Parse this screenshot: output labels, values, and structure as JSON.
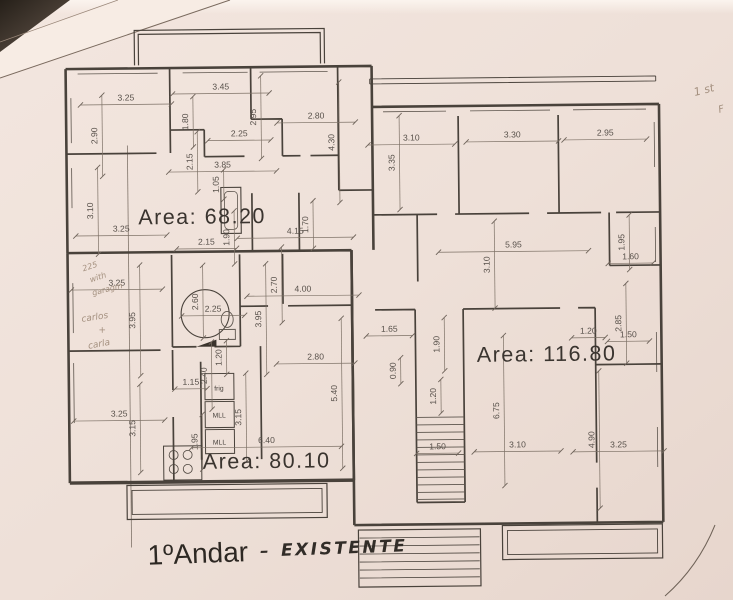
{
  "plan": {
    "caption": {
      "typed": "1ºAndar",
      "dash": "–",
      "handwritten": "EXISTENTE"
    },
    "areas": [
      {
        "text": "Area:  68.20",
        "x": 203,
        "y": 222
      },
      {
        "text": "Area:  116.80",
        "x": 546,
        "y": 363
      },
      {
        "text": "Area:  80.10",
        "x": 265,
        "y": 467
      }
    ],
    "fixtures": [
      {
        "t": "frig",
        "x": 218,
        "y": 389
      },
      {
        "t": "MLL",
        "x": 218,
        "y": 416
      },
      {
        "t": "MLL",
        "x": 218,
        "y": 443
      }
    ],
    "handwritten_notes": [
      {
        "t": "1 st",
        "x": 707,
        "y": 97,
        "s": 11,
        "r": -14
      },
      {
        "t": "F",
        "x": 724,
        "y": 116,
        "s": 10,
        "r": -14
      },
      {
        "t": "225",
        "x": 91,
        "y": 266,
        "s": 8,
        "r": -18
      },
      {
        "t": "with",
        "x": 99,
        "y": 277,
        "s": 8,
        "r": -18
      },
      {
        "t": "garagm",
        "x": 108,
        "y": 289,
        "s": 8,
        "r": -14
      },
      {
        "t": "carlos",
        "x": 95,
        "y": 317,
        "s": 9,
        "r": -8
      },
      {
        "t": "+",
        "x": 102,
        "y": 330,
        "s": 9,
        "r": 0
      },
      {
        "t": "carla",
        "x": 99,
        "y": 344,
        "s": 9,
        "r": -10
      }
    ],
    "dimensions": [
      {
        "t": "3.25",
        "x": 128,
        "y": 98,
        "r": 0
      },
      {
        "t": "2.90",
        "x": 99,
        "y": 133,
        "r": -90
      },
      {
        "t": "3.45",
        "x": 223,
        "y": 88,
        "r": 0
      },
      {
        "t": "1.80",
        "x": 190,
        "y": 120,
        "r": -90
      },
      {
        "t": "2.95",
        "x": 258,
        "y": 116,
        "r": -90
      },
      {
        "t": "2.25",
        "x": 241,
        "y": 135,
        "r": 0
      },
      {
        "t": "2.80",
        "x": 318,
        "y": 118,
        "r": 0
      },
      {
        "t": "4.30",
        "x": 336,
        "y": 142,
        "r": -90
      },
      {
        "t": "2.15",
        "x": 194,
        "y": 160,
        "r": -90
      },
      {
        "t": "3.85",
        "x": 224,
        "y": 166,
        "r": 0
      },
      {
        "t": "1.05",
        "x": 220,
        "y": 183,
        "r": -90
      },
      {
        "t": "3.10",
        "x": 94,
        "y": 208,
        "r": -90
      },
      {
        "t": "3.25",
        "x": 122,
        "y": 229,
        "r": 0
      },
      {
        "t": "2.15",
        "x": 207,
        "y": 243,
        "r": 0
      },
      {
        "t": "1.90",
        "x": 230,
        "y": 236,
        "r": -90
      },
      {
        "t": "4.15",
        "x": 296,
        "y": 233,
        "r": 0
      },
      {
        "t": "1.70",
        "x": 309,
        "y": 224,
        "r": -90
      },
      {
        "t": "2.70",
        "x": 277,
        "y": 284,
        "r": -90
      },
      {
        "t": "4.00",
        "x": 303,
        "y": 291,
        "r": 0
      },
      {
        "t": "3.95",
        "x": 135,
        "y": 318,
        "r": -90
      },
      {
        "t": "3.25",
        "x": 117,
        "y": 283,
        "r": 0
      },
      {
        "t": "2.60",
        "x": 198,
        "y": 300,
        "r": -90
      },
      {
        "t": "2.25",
        "x": 213,
        "y": 310,
        "r": 0
      },
      {
        "t": "3.95",
        "x": 261,
        "y": 318,
        "r": -90
      },
      {
        "t": "1.20",
        "x": 221,
        "y": 356,
        "r": -90
      },
      {
        "t": "2.40",
        "x": 206,
        "y": 374,
        "r": -90
      },
      {
        "t": "1.15",
        "x": 190,
        "y": 383,
        "r": 0
      },
      {
        "t": "3.15",
        "x": 240,
        "y": 416,
        "r": -90
      },
      {
        "t": "1.95",
        "x": 196,
        "y": 440,
        "r": -90
      },
      {
        "t": "3.25",
        "x": 118,
        "y": 414,
        "r": 0
      },
      {
        "t": "3.15",
        "x": 134,
        "y": 426,
        "r": -90
      },
      {
        "t": "2.80",
        "x": 315,
        "y": 359,
        "r": 0
      },
      {
        "t": "5.40",
        "x": 336,
        "y": 393,
        "r": -90
      },
      {
        "t": "6.40",
        "x": 265,
        "y": 442,
        "r": 0
      },
      {
        "t": "3.10",
        "x": 413,
        "y": 141,
        "r": 0
      },
      {
        "t": "3.30",
        "x": 514,
        "y": 139,
        "r": 0
      },
      {
        "t": "2.95",
        "x": 607,
        "y": 138,
        "r": 0
      },
      {
        "t": "3.35",
        "x": 396,
        "y": 163,
        "r": -90
      },
      {
        "t": "5.95",
        "x": 514,
        "y": 249,
        "r": 0
      },
      {
        "t": "3.10",
        "x": 490,
        "y": 266,
        "r": -90
      },
      {
        "t": "1.95",
        "x": 625,
        "y": 245,
        "r": -90
      },
      {
        "t": "1.60",
        "x": 631,
        "y": 262,
        "r": 0
      },
      {
        "t": "1.65",
        "x": 389,
        "y": 332,
        "r": 0
      },
      {
        "t": "1.90",
        "x": 439,
        "y": 345,
        "r": -90
      },
      {
        "t": "0.90",
        "x": 395,
        "y": 371,
        "r": -90
      },
      {
        "t": "1.20",
        "x": 435,
        "y": 397,
        "r": -90
      },
      {
        "t": "1.20",
        "x": 588,
        "y": 336,
        "r": 0
      },
      {
        "t": "2.85",
        "x": 621,
        "y": 326,
        "r": -90
      },
      {
        "t": "1.50",
        "x": 628,
        "y": 340,
        "r": 0
      },
      {
        "t": "6.75",
        "x": 498,
        "y": 412,
        "r": -90
      },
      {
        "t": "1.50",
        "x": 436,
        "y": 450,
        "r": 0
      },
      {
        "t": "3.10",
        "x": 516,
        "y": 449,
        "r": 0
      },
      {
        "t": "4.90",
        "x": 593,
        "y": 442,
        "r": -90
      },
      {
        "t": "3.25",
        "x": 617,
        "y": 450,
        "r": 0
      }
    ],
    "colors": {
      "paper": "#efe1d9",
      "ink": "#49423b",
      "pencil": "#a4907f",
      "corner_shadow": "#262019"
    }
  }
}
